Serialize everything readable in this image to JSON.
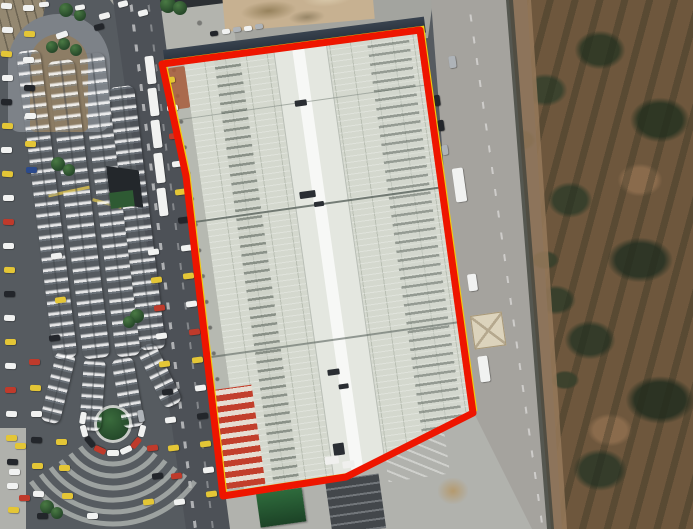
{
  "scene": {
    "type": "satellite-imagery",
    "description": "Aerial view of a large market hall outlined by a red parcel boundary, with a canopied bus terminal and congested roads on the left and brown scrubland with a dirt track on the right"
  },
  "boundary": {
    "points": "162,64 420,30 473,413 346,477 223,496 186,176",
    "stroke_color": "#ee1500",
    "stroke_width": 7,
    "underline_color": "#f2cc0c",
    "underline_width": 2.5
  },
  "colors": {
    "annotation_red": "#ee1500",
    "annotation_yellow": "#f2cc0c",
    "roof_base": "#d4d8ce",
    "roof_light": "#e4e7e0",
    "canopy_white": "#edf0f3",
    "asphalt": "#565b60",
    "road_light": "#a5a39e",
    "pavement": "#a9aaa5",
    "scrub_brown": "#6e573d",
    "bush_green": "#39402c",
    "path_tan": "#bb9a74",
    "island_green": "#2e5b33"
  },
  "vehicle_palette": {
    "w": "#f1f2f1",
    "y": "#e4c636",
    "r": "#bf3a2b",
    "k": "#23262b",
    "s": "#aeb3b8",
    "b": "#2b4a8c"
  },
  "vehicles": [
    [
      6,
      6,
      11,
      6,
      4,
      "w"
    ],
    [
      7,
      30,
      11,
      6,
      2,
      "w"
    ],
    [
      6,
      54,
      11,
      6,
      4,
      "y"
    ],
    [
      7,
      78,
      11,
      6,
      0,
      "w"
    ],
    [
      6,
      102,
      11,
      6,
      3,
      "k"
    ],
    [
      7,
      126,
      11,
      6,
      2,
      "y"
    ],
    [
      6,
      150,
      11,
      6,
      0,
      "w"
    ],
    [
      7,
      174,
      11,
      6,
      4,
      "y"
    ],
    [
      8,
      198,
      11,
      6,
      0,
      "w"
    ],
    [
      8,
      222,
      11,
      6,
      3,
      "r"
    ],
    [
      8,
      246,
      11,
      6,
      0,
      "w"
    ],
    [
      9,
      270,
      11,
      6,
      2,
      "y"
    ],
    [
      9,
      294,
      11,
      6,
      0,
      "k"
    ],
    [
      9,
      318,
      11,
      6,
      3,
      "w"
    ],
    [
      10,
      342,
      11,
      6,
      0,
      "y"
    ],
    [
      10,
      366,
      11,
      6,
      2,
      "w"
    ],
    [
      10,
      390,
      11,
      6,
      0,
      "r"
    ],
    [
      11,
      414,
      11,
      6,
      3,
      "w"
    ],
    [
      11,
      438,
      11,
      6,
      0,
      "y"
    ],
    [
      12,
      462,
      11,
      6,
      2,
      "k"
    ],
    [
      12,
      486,
      11,
      6,
      0,
      "w"
    ],
    [
      13,
      510,
      11,
      6,
      3,
      "y"
    ],
    [
      28,
      8,
      11,
      6,
      0,
      "w"
    ],
    [
      29,
      34,
      11,
      6,
      2,
      "y"
    ],
    [
      28,
      60,
      11,
      6,
      0,
      "w"
    ],
    [
      29,
      88,
      11,
      6,
      3,
      "k"
    ],
    [
      30,
      116,
      11,
      6,
      0,
      "w"
    ],
    [
      30,
      144,
      11,
      6,
      2,
      "y"
    ],
    [
      31,
      170,
      11,
      6,
      0,
      "b"
    ],
    [
      34,
      362,
      11,
      6,
      0,
      "r"
    ],
    [
      35,
      388,
      11,
      6,
      2,
      "y"
    ],
    [
      36,
      414,
      11,
      6,
      0,
      "w"
    ],
    [
      36,
      440,
      11,
      6,
      3,
      "k"
    ],
    [
      37,
      466,
      11,
      6,
      0,
      "y"
    ],
    [
      38,
      494,
      11,
      6,
      2,
      "w"
    ],
    [
      56,
      256,
      11,
      6,
      -7,
      "w"
    ],
    [
      60,
      300,
      11,
      6,
      -7,
      "y"
    ],
    [
      54,
      338,
      11,
      6,
      -7,
      "k"
    ],
    [
      62,
      35,
      12,
      6,
      -20,
      "w"
    ],
    [
      104,
      16,
      11,
      6,
      -15,
      "w"
    ],
    [
      99,
      27,
      10,
      6,
      -15,
      "k"
    ],
    [
      143,
      13,
      10,
      6,
      -15,
      "w"
    ],
    [
      123,
      4,
      10,
      6,
      -15,
      "w"
    ],
    [
      80,
      7,
      10,
      5,
      -10,
      "w"
    ],
    [
      44,
      4,
      10,
      5,
      -5,
      "w"
    ],
    [
      226,
      31,
      8,
      5,
      -8,
      "w"
    ],
    [
      237,
      29,
      8,
      5,
      -8,
      "s"
    ],
    [
      248,
      28,
      8,
      5,
      -8,
      "w"
    ],
    [
      259,
      26,
      8,
      5,
      -8,
      "s"
    ],
    [
      214,
      33,
      8,
      5,
      -8,
      "k"
    ],
    [
      153,
      252,
      11,
      6,
      -7,
      "w"
    ],
    [
      156,
      280,
      11,
      6,
      -7,
      "y"
    ],
    [
      159,
      308,
      11,
      6,
      -7,
      "r"
    ],
    [
      161,
      336,
      11,
      6,
      -7,
      "w"
    ],
    [
      164,
      364,
      11,
      6,
      -7,
      "y"
    ],
    [
      167,
      392,
      11,
      6,
      -7,
      "k"
    ],
    [
      170,
      420,
      11,
      6,
      -7,
      "w"
    ],
    [
      173,
      448,
      11,
      6,
      -7,
      "y"
    ],
    [
      176,
      476,
      11,
      6,
      -7,
      "r"
    ],
    [
      179,
      502,
      11,
      6,
      -7,
      "w"
    ],
    [
      169,
      80,
      11,
      6,
      -7,
      "y"
    ],
    [
      172,
      108,
      11,
      6,
      -7,
      "w"
    ],
    [
      174,
      136,
      11,
      6,
      -7,
      "r"
    ],
    [
      177,
      164,
      11,
      6,
      -7,
      "w"
    ],
    [
      180,
      192,
      11,
      6,
      -7,
      "y"
    ],
    [
      183,
      220,
      11,
      6,
      -7,
      "k"
    ],
    [
      186,
      248,
      11,
      6,
      -7,
      "w"
    ],
    [
      188,
      276,
      11,
      6,
      -7,
      "y"
    ],
    [
      191,
      304,
      11,
      6,
      -7,
      "w"
    ],
    [
      194,
      332,
      11,
      6,
      -7,
      "r"
    ],
    [
      197,
      360,
      11,
      6,
      -7,
      "y"
    ],
    [
      200,
      388,
      11,
      6,
      -7,
      "w"
    ],
    [
      202,
      416,
      11,
      6,
      -7,
      "k"
    ],
    [
      205,
      444,
      11,
      6,
      -7,
      "y"
    ],
    [
      208,
      470,
      11,
      6,
      -7,
      "w"
    ],
    [
      211,
      494,
      11,
      6,
      -7,
      "y"
    ],
    [
      150,
      70,
      9,
      28,
      -7,
      "w"
    ],
    [
      153,
      102,
      9,
      28,
      -7,
      "w"
    ],
    [
      156,
      134,
      9,
      28,
      -7,
      "w"
    ],
    [
      159,
      168,
      9,
      30,
      -7,
      "w"
    ],
    [
      162,
      202,
      9,
      28,
      -7,
      "w"
    ],
    [
      437,
      100,
      6,
      11,
      -8,
      "k"
    ],
    [
      441,
      125,
      6,
      11,
      -8,
      "k"
    ],
    [
      445,
      150,
      6,
      10,
      -8,
      "s"
    ],
    [
      459,
      185,
      11,
      34,
      -8,
      "w"
    ],
    [
      472,
      282,
      9,
      17,
      -8,
      "w"
    ],
    [
      484,
      369,
      10,
      26,
      -8,
      "w"
    ],
    [
      452,
      62,
      7,
      12,
      -8,
      "s"
    ],
    [
      141,
      416,
      12,
      6,
      80,
      "s"
    ],
    [
      142,
      431,
      12,
      6,
      105,
      "w"
    ],
    [
      136,
      443,
      12,
      6,
      130,
      "r"
    ],
    [
      126,
      450,
      12,
      6,
      155,
      "w"
    ],
    [
      113,
      453,
      12,
      6,
      180,
      "w"
    ],
    [
      100,
      450,
      12,
      6,
      205,
      "r"
    ],
    [
      90,
      442,
      12,
      6,
      230,
      "k"
    ],
    [
      84,
      431,
      12,
      6,
      255,
      "w"
    ],
    [
      83,
      418,
      12,
      6,
      280,
      "w"
    ],
    [
      20,
      446,
      11,
      6,
      0,
      "y"
    ],
    [
      14,
      472,
      11,
      6,
      0,
      "w"
    ],
    [
      24,
      498,
      11,
      6,
      0,
      "r"
    ],
    [
      61,
      442,
      11,
      6,
      0,
      "y"
    ],
    [
      64,
      468,
      11,
      6,
      0,
      "y"
    ],
    [
      67,
      496,
      11,
      6,
      0,
      "y"
    ],
    [
      42,
      516,
      11,
      6,
      0,
      "k"
    ],
    [
      92,
      516,
      11,
      6,
      0,
      "w"
    ],
    [
      152,
      448,
      11,
      6,
      -7,
      "r"
    ],
    [
      157,
      476,
      11,
      6,
      -7,
      "k"
    ],
    [
      148,
      502,
      11,
      6,
      -7,
      "y"
    ]
  ],
  "canopies": [
    [
      16,
      52,
      24,
      310,
      -7
    ],
    [
      47,
      62,
      27,
      300,
      -7
    ],
    [
      79,
      55,
      25,
      305,
      -7
    ],
    [
      108,
      88,
      26,
      265,
      -7
    ],
    [
      57,
      350,
      20,
      72,
      14
    ],
    [
      84,
      358,
      22,
      72,
      4
    ],
    [
      111,
      360,
      22,
      70,
      -10
    ],
    [
      136,
      350,
      20,
      66,
      -26
    ]
  ],
  "trees": [
    [
      66,
      10,
      7
    ],
    [
      80,
      15,
      6
    ],
    [
      52,
      47,
      6
    ],
    [
      64,
      44,
      6
    ],
    [
      76,
      50,
      6
    ],
    [
      58,
      164,
      7
    ],
    [
      69,
      170,
      6
    ],
    [
      122,
      183,
      7
    ],
    [
      132,
      189,
      6
    ],
    [
      137,
      316,
      7
    ],
    [
      129,
      322,
      6
    ],
    [
      47,
      507,
      7
    ],
    [
      57,
      513,
      6
    ],
    [
      168,
      5,
      8
    ],
    [
      180,
      8,
      7
    ]
  ],
  "structures": [
    {
      "name": "gatehouse",
      "cls": "gatehouse",
      "x": 470,
      "y": 316,
      "w": 32,
      "h": 34,
      "rot": -8
    },
    {
      "name": "green-roof-structure",
      "cls": "green-roof",
      "x": 256,
      "y": 494,
      "w": 46,
      "h": 34,
      "rot": -8
    },
    {
      "name": "dark-shed",
      "cls": "dark-shed",
      "x": 325,
      "y": 481,
      "w": 54,
      "h": 55,
      "rot": -8
    },
    {
      "name": "terminal-dark-structure",
      "cls": "dark-tri",
      "x": 106,
      "y": 166,
      "w": 32,
      "h": 46,
      "rot": -7
    },
    {
      "name": "green-tarp",
      "cls": "green-tarp",
      "x": 109,
      "y": 193,
      "w": 24,
      "h": 16,
      "rot": -7
    },
    {
      "name": "dirt-pile",
      "cls": "dirt-pile",
      "x": 438,
      "y": 478,
      "w": 30,
      "h": 26,
      "rot": 0
    }
  ],
  "roof_marks_dark": [
    [
      126,
      55,
      12,
      6
    ],
    [
      118,
      146,
      16,
      7
    ],
    [
      131,
      158,
      10,
      5
    ],
    [
      121,
      326,
      12,
      6
    ],
    [
      130,
      342,
      10,
      5
    ],
    [
      116,
      400,
      11,
      12
    ]
  ],
  "roof_marks_light": [
    [
      106,
      412,
      14,
      8
    ],
    [
      123,
      419,
      12,
      7
    ]
  ],
  "road_arc_markings": {
    "cx": 113,
    "cy": 424,
    "radii": [
      40,
      52,
      64,
      76,
      88,
      100
    ],
    "startDeg": 35,
    "endDeg": 145,
    "width": 5,
    "color": "#b6b9b5"
  }
}
